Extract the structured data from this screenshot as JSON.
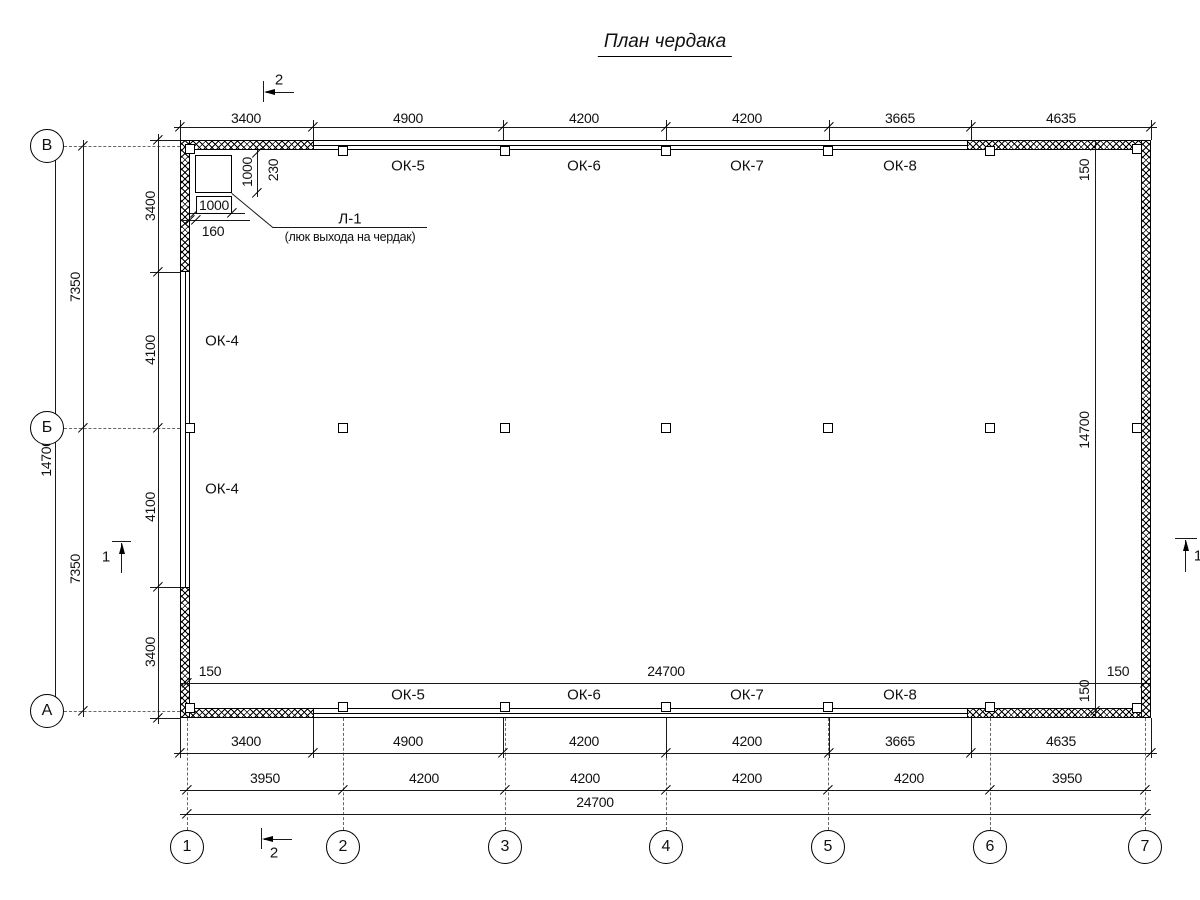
{
  "title": "План чердака",
  "axis_rows": [
    "В",
    "Б",
    "А"
  ],
  "axis_cols": [
    "1",
    "2",
    "3",
    "4",
    "5",
    "6",
    "7"
  ],
  "section_markers": {
    "sec1": "1",
    "sec2": "2"
  },
  "dims_top": [
    "3400",
    "4900",
    "4200",
    "4200",
    "3665",
    "4635"
  ],
  "dims_bottom_row1": [
    "3400",
    "4900",
    "4200",
    "4200",
    "3665",
    "4635"
  ],
  "dims_bottom_row2": [
    "3950",
    "4200",
    "4200",
    "4200",
    "4200",
    "3950"
  ],
  "dims_bottom_total": "24700",
  "dims_left_inner": [
    "3400",
    "4100",
    "4100",
    "3400"
  ],
  "dims_left_mid": [
    "7350",
    "7350"
  ],
  "dims_left_total": "14700",
  "dims_inner": {
    "width": "24700",
    "height": "14700",
    "wall_offset": "150"
  },
  "windows_top": [
    "ОК-5",
    "ОК-6",
    "ОК-7",
    "ОК-8"
  ],
  "windows_bottom": [
    "ОК-5",
    "ОК-6",
    "ОК-7",
    "ОК-8"
  ],
  "windows_left": [
    "ОК-4",
    "ОК-4"
  ],
  "hatch_door": {
    "label": "Л-1",
    "description": "(люк выхода на чердак)",
    "width": "1000",
    "height": "1000",
    "offset_x": "160",
    "offset_y": "230"
  }
}
